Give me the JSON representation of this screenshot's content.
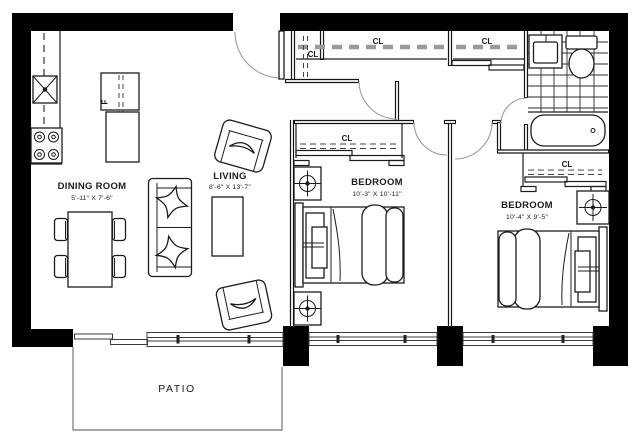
{
  "rooms": {
    "dining": {
      "label": "DINING ROOM",
      "dims": "5'-11\" X 7'-6\""
    },
    "living": {
      "label": "LIVING",
      "dims": "8'-6\" X 13'-7\""
    },
    "bedroom1": {
      "label": "BEDROOM",
      "dims": "10'-3\" X 10'-11\""
    },
    "bedroom2": {
      "label": "BEDROOM",
      "dims": "10'-4\" X 9'-5\""
    },
    "patio": {
      "label": "PATIO"
    }
  },
  "closets": {
    "entry_closet": "CL",
    "hall_closet_1": "CL",
    "hall_closet_2": "CL",
    "bedroom1_closet": "CL",
    "bedroom2_closet": "CL"
  },
  "appliances": {
    "fridge_label": "F"
  },
  "colors": {
    "wall": "#000000",
    "line": "#1c1c1c",
    "muted_line": "#9b9b9b",
    "background": "#ffffff"
  }
}
